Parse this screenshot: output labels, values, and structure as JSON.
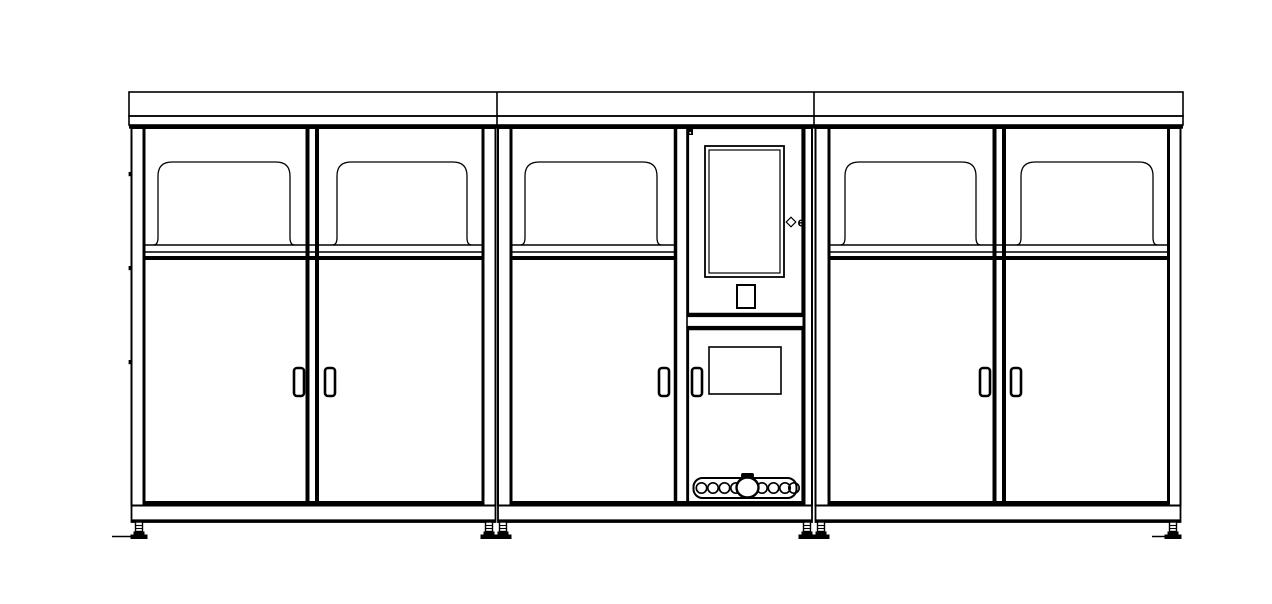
{
  "drawing": {
    "canvas": {
      "w": 1272,
      "h": 604,
      "bg": "#ffffff",
      "ink": "#000000"
    },
    "canopy": {
      "x0": 129,
      "x1": 1183,
      "y_top": 92,
      "y_mid": 116,
      "y_bot": 125,
      "dividers": [
        497,
        814
      ]
    },
    "body": {
      "y_top": 128,
      "y_bottom": 505.5,
      "rail_y1": 245,
      "rail_y2": 252,
      "door_top_y": 258,
      "bottom_rail_y": 503,
      "plinth_y": 522
    },
    "windows": {
      "y_top": 162,
      "y_bottom": 245,
      "corner_r": 14,
      "flare": 4.5
    },
    "handles": {
      "y": 368,
      "w": 10,
      "h": 28
    },
    "modules": [
      {
        "name": "left-cabinet",
        "x0": 131.5,
        "x1": 495.5,
        "inner_l": 144,
        "inner_r": 483,
        "rail": [
          144,
          483
        ],
        "dividers": [
          {
            "x": 307.5,
            "w": 4
          },
          {
            "x": 317,
            "w": 4
          }
        ],
        "windows": [
          [
            158,
            290
          ],
          [
            337,
            467
          ]
        ],
        "handles": [
          294,
          325
        ]
      },
      {
        "name": "center-cabinet",
        "x0": 498,
        "x1": 812,
        "inner_l": 511,
        "inner_r": 804,
        "rail": [
          511,
          675.5
        ],
        "dividers": [
          {
            "x": 675.5,
            "w": 3.5
          },
          {
            "x": 687,
            "w": 1.6
          }
        ],
        "windows": [
          [
            525,
            657
          ]
        ],
        "handles": [
          659
        ]
      },
      {
        "name": "right-cabinet",
        "x0": 815.5,
        "x1": 1180.5,
        "inner_l": 829,
        "inner_r": 1168.5,
        "rail": [
          829,
          1168.5
        ],
        "dividers": [
          {
            "x": 994.5,
            "w": 4
          },
          {
            "x": 1004,
            "w": 4
          }
        ],
        "windows": [
          [
            845,
            976
          ],
          [
            1021,
            1153
          ]
        ],
        "handles": [
          980,
          1011
        ]
      }
    ],
    "panel": {
      "x0": 688,
      "x1": 802.5,
      "upper_door": {
        "y0": 128,
        "y1": 316
      },
      "screen_outer": [
        705,
        146,
        79,
        131
      ],
      "screen_inner": [
        709,
        150,
        71,
        123
      ],
      "lock_icon": [
        687.5,
        128.5,
        5.5,
        6.5
      ],
      "diamond_icon": {
        "cx": 791,
        "cy": 222,
        "r": 4.8
      },
      "side_marker": "e",
      "marker_pos": [
        797.5,
        226.5
      ],
      "slot": [
        737,
        285,
        18,
        23
      ],
      "lower_door": {
        "y0": 327,
        "y1": 503
      },
      "hatch": [
        709,
        347,
        72,
        47
      ],
      "handle_x": 692,
      "tray": {
        "x": 693.5,
        "y": 478,
        "w": 103,
        "h": 20,
        "rx": 9,
        "r": 5.2,
        "cy": 488,
        "left": [
          701.5,
          713,
          724.5,
          736
        ],
        "right": [
          762,
          773.5,
          785,
          794
        ],
        "center": {
          "cx": 747.5,
          "cy": 487.5,
          "rx": 11,
          "ry": 10
        },
        "tab": [
          741,
          473,
          13,
          5
        ]
      }
    },
    "hinges": {
      "x": 128.6,
      "w": 3.6,
      "h": 4.2,
      "ys": [
        172,
        266,
        360
      ]
    },
    "feet": {
      "y": 522,
      "centers": [
        139,
        489,
        503,
        807,
        821,
        1173
      ]
    },
    "ground_ticks": [
      [
        112,
        536.5,
        138,
        536.5
      ],
      [
        1152,
        536.5,
        1178,
        536.5
      ]
    ]
  }
}
